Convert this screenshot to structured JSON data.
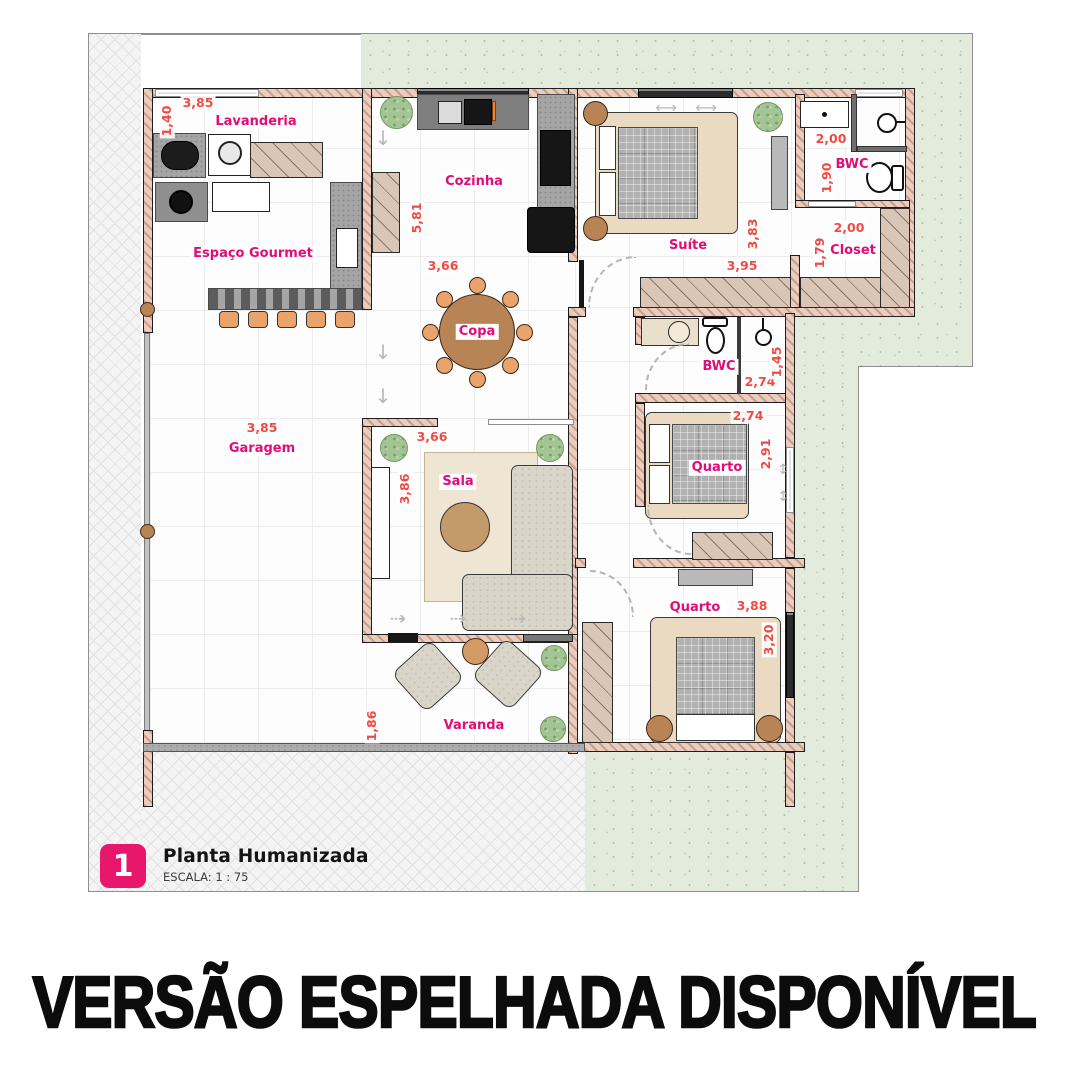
{
  "banner": {
    "text": "VERSÃO ESPELHADA DISPONÍVEL"
  },
  "title_block": {
    "number": "1",
    "title": "Planta Humanizada",
    "scale": "ESCALA: 1 : 75"
  },
  "colors": {
    "label": "#e20b77",
    "dimension": "#ef4b44",
    "accent_pink": "#e8176b",
    "wall_fill": "#ecccbc",
    "grass": "#e3ecdc"
  },
  "rooms": {
    "lavanderia": {
      "label": "Lavanderia",
      "dim_w": "3,85",
      "dim_h": "1,40"
    },
    "espaco_gourmet": {
      "label": "Espaço Gourmet"
    },
    "cozinha": {
      "label": "Cozinha",
      "dim_h": "5,81",
      "dim_w": "3,66"
    },
    "copa": {
      "label": "Copa"
    },
    "suite": {
      "label": "Suíte",
      "dim_h": "3,83",
      "dim_w": "3,95"
    },
    "bwc_suite": {
      "label": "BWC",
      "dim_w": "2,00",
      "dim_h": "1,90"
    },
    "closet": {
      "label": "Closet",
      "dim_w": "2,00",
      "dim_h": "1,79"
    },
    "garagem": {
      "label": "Garagem",
      "dim_w": "3,85"
    },
    "sala": {
      "label": "Sala",
      "dim_w": "3,66",
      "dim_h": "3,86"
    },
    "bwc_social": {
      "label": "BWC",
      "dim_w": "2,74",
      "dim_h": "1,45"
    },
    "quarto_meio": {
      "label": "Quarto",
      "dim_w": "2,74",
      "dim_h": "2,91"
    },
    "quarto_fundo": {
      "label": "Quarto",
      "dim_w": "3,88",
      "dim_h": "3,20"
    },
    "varanda": {
      "label": "Varanda",
      "dim_h": "1,86"
    }
  }
}
